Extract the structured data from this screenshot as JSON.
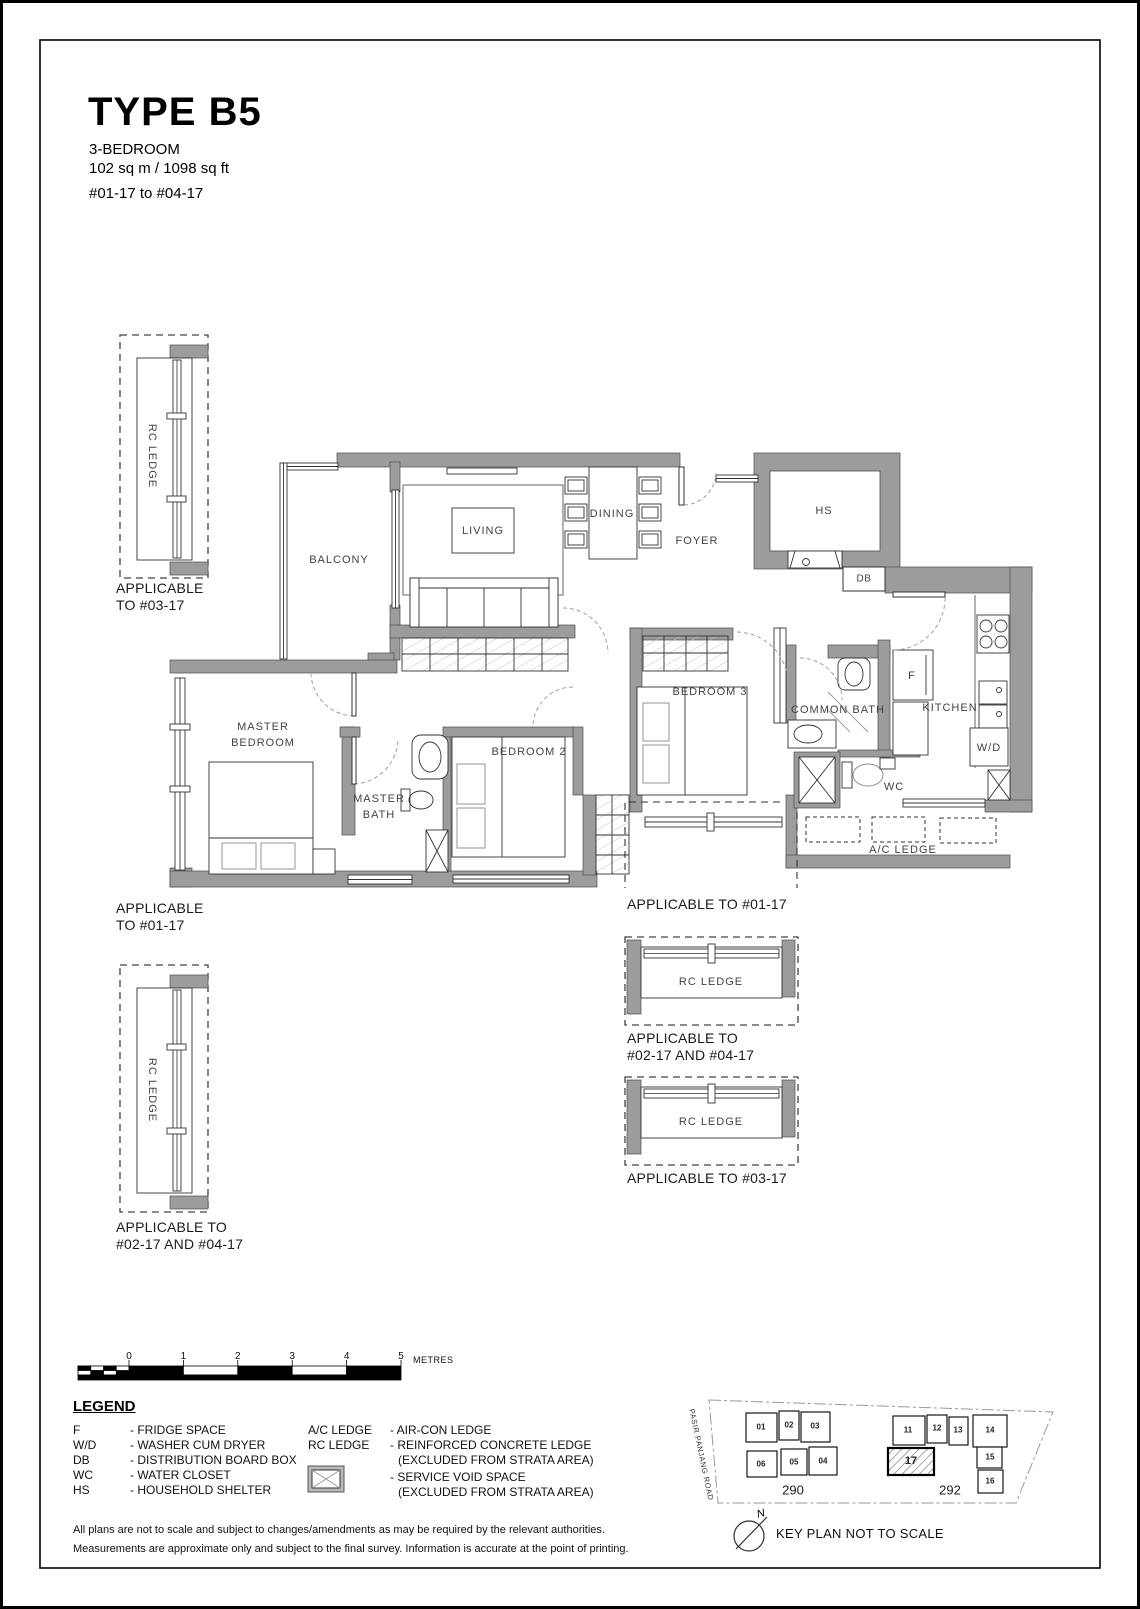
{
  "header": {
    "type": "TYPE B5",
    "bedrooms": "3-BEDROOM",
    "area": "102 sq m / 1098 sq ft",
    "stack": "#01-17 to #04-17"
  },
  "plan": {
    "rooms": {
      "balcony": "BALCONY",
      "living": "LIVING",
      "dining": "DINING",
      "foyer": "FOYER",
      "hs": "HS",
      "db": "DB",
      "master_line1": "MASTER",
      "master_line2": "BEDROOM",
      "master_bath_line1": "MASTER",
      "master_bath_line2": "BATH",
      "bedroom2": "BEDROOM 2",
      "bedroom3": "BEDROOM 3",
      "common_bath": "COMMON BATH",
      "kitchen": "KITCHEN",
      "fridge": "F",
      "washer_dryer": "W/D",
      "wc": "WC",
      "ac_ledge": "A/C LEDGE",
      "rc_ledge": "RC LEDGE"
    },
    "applicability": {
      "top_left_line1": "APPLICABLE",
      "top_left_line2": "TO #03-17",
      "mid_left_line1": "APPLICABLE",
      "mid_left_line2": "TO #01-17",
      "bottom_left_line1": "APPLICABLE TO",
      "bottom_left_line2": "#02-17 AND #04-17",
      "right1": "APPLICABLE TO #01-17",
      "right2_line1": "APPLICABLE TO",
      "right2_line2": "#02-17 AND #04-17",
      "right3": "APPLICABLE TO #03-17"
    }
  },
  "scale_bar": {
    "ticks": [
      "0",
      "1",
      "2",
      "3",
      "4",
      "5"
    ],
    "unit": "METRES"
  },
  "legend": {
    "heading": "LEGEND",
    "left": [
      [
        "F",
        "- FRIDGE SPACE"
      ],
      [
        "W/D",
        "- WASHER CUM DRYER"
      ],
      [
        "DB",
        "- DISTRIBUTION BOARD BOX"
      ],
      [
        "WC",
        "- WATER CLOSET"
      ],
      [
        "HS",
        "- HOUSEHOLD SHELTER"
      ]
    ],
    "right": [
      [
        "A/C LEDGE",
        "- AIR-CON LEDGE"
      ],
      [
        "RC LEDGE",
        "- REINFORCED CONCRETE LEDGE"
      ],
      [
        "",
        "(EXCLUDED FROM STRATA AREA)"
      ],
      [
        "",
        "- SERVICE VOID SPACE"
      ],
      [
        "",
        "(EXCLUDED FROM STRATA AREA)"
      ]
    ]
  },
  "key_plan": {
    "road": "PASIR PANJANG ROAD",
    "north": "N",
    "caption": "KEY PLAN NOT TO SCALE",
    "block_left": {
      "number": "290",
      "units": [
        "01",
        "02",
        "03",
        "06",
        "05",
        "04"
      ]
    },
    "block_right": {
      "number": "292",
      "units": [
        "11",
        "12",
        "13",
        "14",
        "15",
        "16"
      ],
      "highlight": "17"
    }
  },
  "footer": {
    "line1": "All plans are not to scale and subject to changes/amendments as may be required by the relevant authorities.",
    "line2": "Measurements are approximate only and subject to the final survey. Information is accurate at the point of printing."
  },
  "colors": {
    "wall": "#9c9c9c",
    "line": "#333333",
    "label": "#3d4350"
  }
}
